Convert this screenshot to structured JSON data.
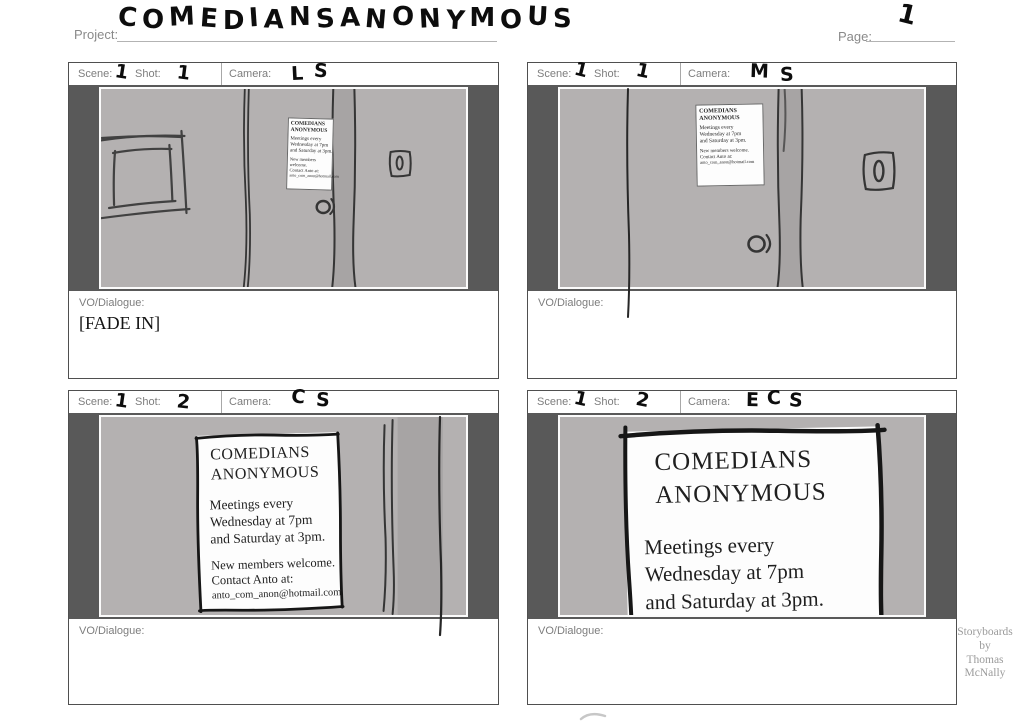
{
  "page": {
    "project_label": "Project:",
    "project_title": "COMEDIANS ANONYMOUS",
    "page_label": "Page:",
    "page_number": "1",
    "credit": "Storyboards\nby\nThomas\nMcNally"
  },
  "labels": {
    "scene": "Scene:",
    "shot": "Shot:",
    "camera": "Camera:",
    "vo": "VO/Dialogue:"
  },
  "poster": {
    "title": "COMEDIANS\nANONYMOUS",
    "body": "Meetings every\nWednesday at 7pm\nand Saturday at 3pm.",
    "footer": "New members welcome.\nContact Anto at:",
    "email": "anto_com_anon@hotmail.com"
  },
  "panels": [
    {
      "scene": "1",
      "shot": "1",
      "camera": "LS",
      "dialogue": "[FADE IN]"
    },
    {
      "scene": "1",
      "shot": "1",
      "camera": "MS",
      "dialogue": ""
    },
    {
      "scene": "1",
      "shot": "2",
      "camera": "CS",
      "dialogue": ""
    },
    {
      "scene": "1",
      "shot": "2",
      "camera": "ECS",
      "dialogue": ""
    }
  ],
  "colors": {
    "letterbox": "#595959",
    "wall": "#b4b1b1",
    "door_strip": "#a7a4a4"
  }
}
